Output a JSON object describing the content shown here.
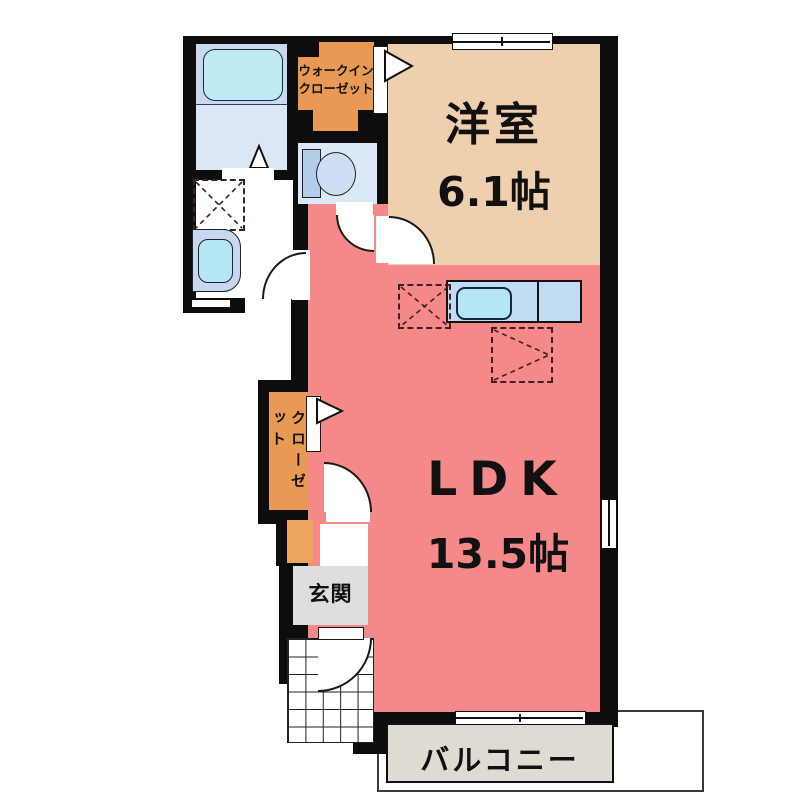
{
  "plan": {
    "type": "apartment-floorplan",
    "rooms": {
      "western_room": {
        "label": "洋室",
        "size": "6.1帖"
      },
      "ldk": {
        "label": "LDK",
        "size": "13.5帖"
      },
      "walk_in_closet": {
        "label_line1": "ウォークイン",
        "label_line2": "クローゼット"
      },
      "closet": {
        "label": "クローゼット"
      },
      "entrance": {
        "label": "玄関"
      },
      "balcony": {
        "label": "バルコニー"
      }
    },
    "colors": {
      "wall": "#0d0d0d",
      "ldk_salmon": "#f58888",
      "western_room_tan": "#eed0ae",
      "closet_orange": "#e89a55",
      "shoe_cabinet_orange": "#eda45e",
      "bathroom_blue": "#dbe7f6",
      "bathtub_band_blue": "#c9d9ef",
      "tub_cyan": "#bfeaf4",
      "toilet_room_blue": "#dbe8f7",
      "toilet_tank_blue": "#b3cdea",
      "kitchen_counter_blue": "#c2dcf4",
      "sink_cyan": "#b4e7f3",
      "washbasin_blue": "#c6d9f0",
      "entrance_gray": "#dcdedf",
      "balcony_gray": "#dfdbd3"
    },
    "fixtures": [
      "bathtub",
      "washbasin",
      "washing-machine-space",
      "toilet",
      "kitchen-sink",
      "refrigerator-space",
      "cupboard-space",
      "entrance-door"
    ]
  }
}
